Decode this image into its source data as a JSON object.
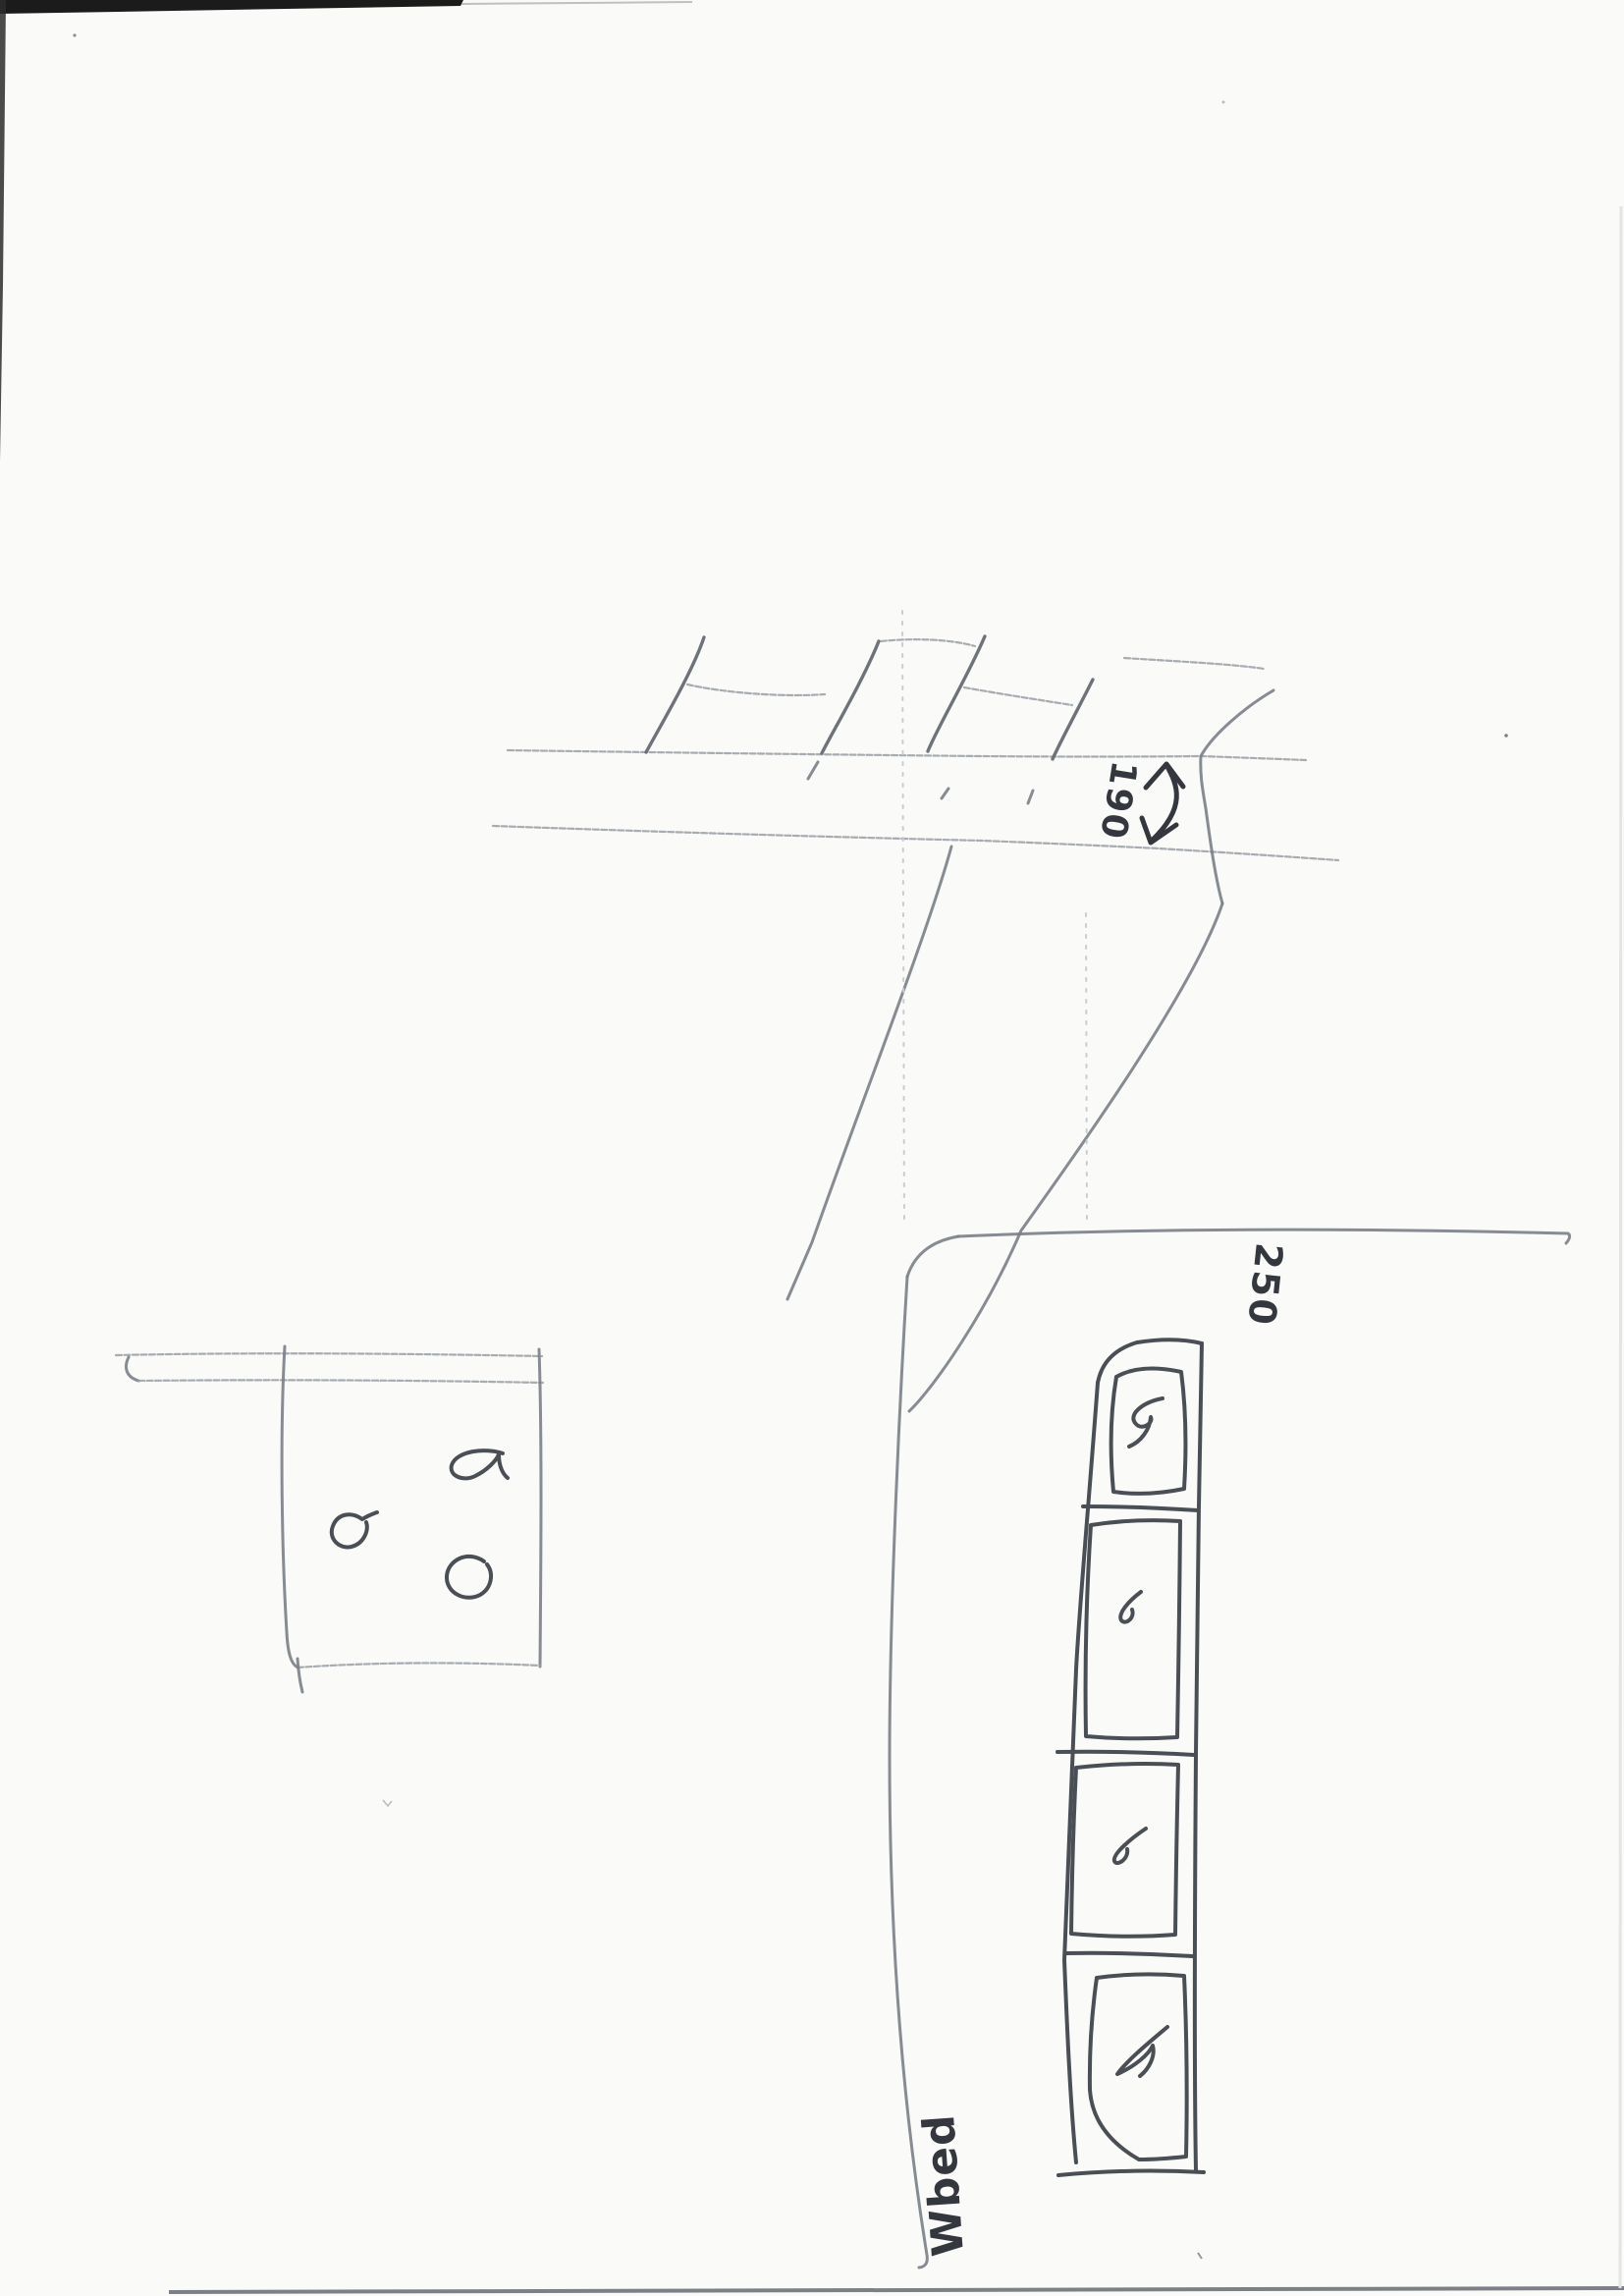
{
  "page": {
    "description": "Scanned sheet of paper with hand-drawn pencil sketches (street with fence, small square with doodles, planting bed with four framed panels)",
    "background_color": "#fafaf8",
    "pencil_colors": {
      "light": "#989da5",
      "medium": "#7a7f87",
      "dark": "#4a4e55",
      "heavy": "#34383e"
    }
  },
  "street_sketch": {
    "width_arrow_label": "190"
  },
  "bed_sketch": {
    "width_label": "250",
    "name_label": "Wbed",
    "panel_count": 4
  }
}
